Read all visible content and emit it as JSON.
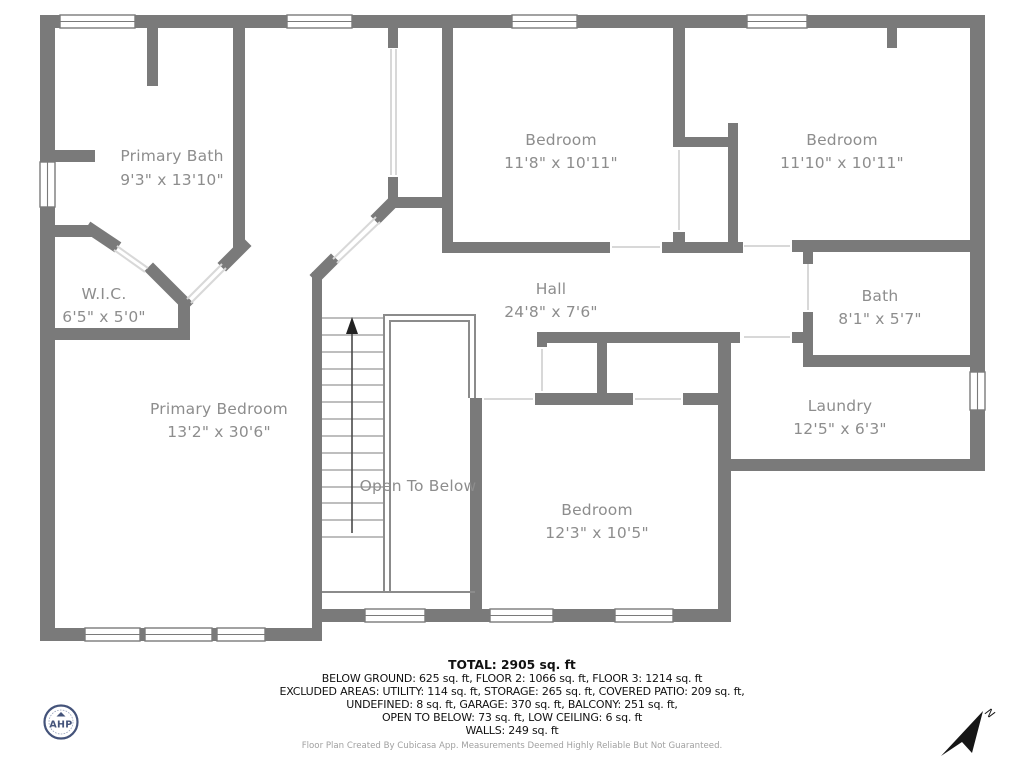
{
  "plan": {
    "rooms": [
      {
        "id": "primary-bath",
        "name": "Primary Bath",
        "dims": "9'3\" x 13'10\""
      },
      {
        "id": "wic",
        "name": "W.I.C.",
        "dims": "6'5\" x 5'0\""
      },
      {
        "id": "primary-bedroom",
        "name": "Primary Bedroom",
        "dims": "13'2\" x 30'6\""
      },
      {
        "id": "bedroom-top-middle",
        "name": "Bedroom",
        "dims": "11'8\" x 10'11\""
      },
      {
        "id": "bedroom-top-right",
        "name": "Bedroom",
        "dims": "11'10\" x 10'11\""
      },
      {
        "id": "hall",
        "name": "Hall",
        "dims": "24'8\" x 7'6\""
      },
      {
        "id": "bath",
        "name": "Bath",
        "dims": "8'1\" x 5'7\""
      },
      {
        "id": "laundry",
        "name": "Laundry",
        "dims": "12'5\" x 6'3\""
      },
      {
        "id": "bedroom-bottom",
        "name": "Bedroom",
        "dims": "12'3\" x 10'5\""
      },
      {
        "id": "open-to-below",
        "name": "Open To Below",
        "dims": ""
      }
    ]
  },
  "summary": {
    "total": "TOTAL: 2905 sq. ft",
    "line2": "BELOW GROUND: 625 sq. ft, FLOOR 2: 1066 sq. ft, FLOOR 3: 1214 sq. ft",
    "line3": "EXCLUDED AREAS: UTILITY: 114 sq. ft, STORAGE: 265 sq. ft, COVERED PATIO: 209 sq. ft,",
    "line4": "UNDEFINED: 8 sq. ft, GARAGE: 370 sq. ft, BALCONY: 251 sq. ft,",
    "line5": "OPEN TO BELOW: 73 sq. ft, LOW CEILING: 6 sq. ft",
    "line6": "WALLS: 249 sq. ft",
    "disclaimer": "Floor Plan Created By Cubicasa App. Measurements Deemed Highly Reliable But Not Guaranteed."
  },
  "logo": {
    "text": "AHP"
  },
  "compass": {
    "label": "N"
  },
  "colors": {
    "wall": "#7a7a7a",
    "room_label": "#8d8d8d",
    "door_line": "#d8d8d8",
    "footer_text": "#111111",
    "disclaimer_text": "#a0a0a0",
    "logo_navy": "#44537a"
  }
}
